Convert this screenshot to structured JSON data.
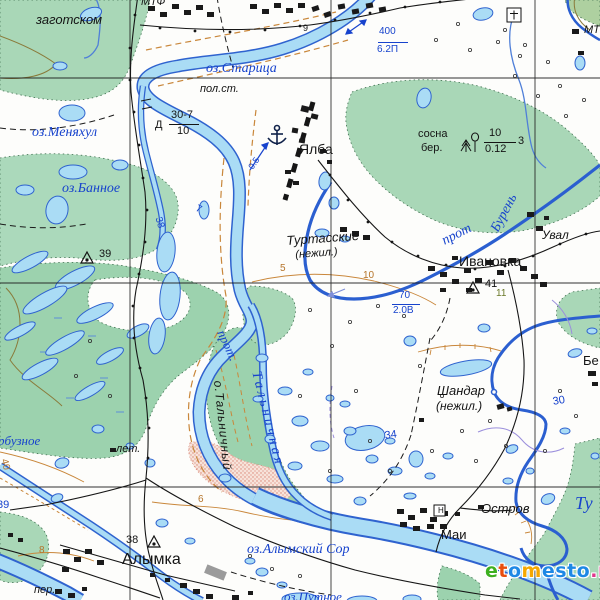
{
  "watermark": {
    "text": "etomesto.ru",
    "letters": [
      {
        "ch": "e",
        "color": "#3db020"
      },
      {
        "ch": "t",
        "color": "#e84e0f"
      },
      {
        "ch": "o",
        "color": "#1e88e5"
      },
      {
        "ch": "m",
        "color": "#f5a800"
      },
      {
        "ch": "e",
        "color": "#1e88e5"
      },
      {
        "ch": "s",
        "color": "#1e88e5"
      },
      {
        "ch": "t",
        "color": "#1e88e5"
      },
      {
        "ch": "o",
        "color": "#1e88e5"
      },
      {
        "ch": ".",
        "color": "#e0368c"
      },
      {
        "ch": "r",
        "color": "#e0368c"
      },
      {
        "ch": "u",
        "color": "#e0368c"
      }
    ]
  },
  "map": {
    "colors": {
      "water_fill": "#aadcf5",
      "water_line": "#2f63cf",
      "forest": "#a9d7b7",
      "marsh_forest": "#9cd2ae",
      "contour": "#c9873b",
      "sand": "#f7e3da",
      "building": "#1a1a1a",
      "grid": "#1b1b1b",
      "label_water": "#1743cd",
      "label_black": "#141414"
    },
    "labels": [
      {
        "id": "oz-staritsa",
        "text": "оз.Старица",
        "cls": "water",
        "x": 206,
        "y": 62,
        "size": 14
      },
      {
        "id": "oz-menyakhul",
        "text": "оз.Меняхул",
        "cls": "water",
        "x": 32,
        "y": 126,
        "size": 14
      },
      {
        "id": "oz-bannoe",
        "text": "оз.Банное",
        "cls": "water",
        "x": 62,
        "y": 182,
        "size": 14
      },
      {
        "id": "prot-buren-1",
        "text": "прот",
        "cls": "water",
        "x": 440,
        "y": 236,
        "size": 14,
        "rot": -27
      },
      {
        "id": "prot-buren-2",
        "text": "Бурень",
        "cls": "water",
        "x": 489,
        "y": 228,
        "size": 14,
        "rot": -62
      },
      {
        "id": "prot-talnichnaya-1",
        "text": "прот.",
        "cls": "water",
        "x": 227,
        "y": 328,
        "size": 13,
        "rot": 65
      },
      {
        "id": "prot-talnichnaya-2",
        "text": "Тальничная",
        "cls": "water",
        "x": 262,
        "y": 370,
        "size": 14,
        "rot": 76,
        "ls": 3
      },
      {
        "id": "o-talnichny",
        "text": "о.Тальничный",
        "cls": "blki",
        "x": 224,
        "y": 380,
        "size": 12,
        "rot": 84,
        "ls": 1
      },
      {
        "id": "oz-alymsky-sor",
        "text": "оз.Алымский Сор",
        "cls": "water",
        "x": 247,
        "y": 543,
        "size": 14
      },
      {
        "id": "oz-putnoe",
        "text": "оз.Путное",
        "cls": "water",
        "x": 284,
        "y": 590,
        "size": 13
      },
      {
        "id": "river-tu",
        "text": "Ту",
        "cls": "water",
        "x": 575,
        "y": 494,
        "size": 18
      },
      {
        "id": "oz-arbuznoe",
        "text": "рбузное",
        "cls": "water",
        "x": -2,
        "y": 434,
        "size": 13
      },
      {
        "id": "w-400",
        "text": "400",
        "cls": "blue-num",
        "x": 379,
        "y": 27,
        "size": 10
      },
      {
        "id": "w-62p",
        "text": "6.2П",
        "cls": "blue-num",
        "x": 377,
        "y": 45,
        "size": 10
      },
      {
        "id": "w-70",
        "text": "70",
        "cls": "blue-num",
        "x": 399,
        "y": 291,
        "size": 10
      },
      {
        "id": "w-20v",
        "text": "2.0В",
        "cls": "blue-num",
        "x": 393,
        "y": 306,
        "size": 10
      },
      {
        "id": "flow-05",
        "text": "0.5",
        "cls": "blue-num",
        "x": 247,
        "y": 166,
        "size": 9,
        "rot": -55
      },
      {
        "id": "num-38-blue",
        "text": "38",
        "cls": "blue-num",
        "x": 162,
        "y": 216,
        "size": 10,
        "rot": 72
      },
      {
        "id": "num-7-blue",
        "text": "7",
        "cls": "blue-num",
        "x": 198,
        "y": 204,
        "size": 10,
        "rot": 25
      },
      {
        "id": "num-34",
        "text": "34",
        "cls": "blue-num",
        "x": 384,
        "y": 431,
        "size": 11,
        "rot": -8
      },
      {
        "id": "num-30",
        "text": "30",
        "cls": "blue-num",
        "x": 552,
        "y": 397,
        "size": 11,
        "rot": -10
      },
      {
        "id": "num-39-blue",
        "text": "39",
        "cls": "blue-num",
        "x": -3,
        "y": 500,
        "size": 11
      },
      {
        "id": "yalba",
        "text": "Ялба",
        "cls": "blk",
        "x": 299,
        "y": 142,
        "size": 14
      },
      {
        "id": "ivanovka",
        "text": "Ивановка",
        "cls": "blk",
        "x": 459,
        "y": 254,
        "size": 14
      },
      {
        "id": "alymka",
        "text": "Алымка",
        "cls": "blk",
        "x": 122,
        "y": 552,
        "size": 16
      },
      {
        "id": "mai",
        "text": "Маи",
        "cls": "blk",
        "x": 441,
        "y": 528,
        "size": 13
      },
      {
        "id": "zagotskom",
        "text": "заготском",
        "cls": "blki",
        "x": 36,
        "y": 13,
        "size": 13
      },
      {
        "id": "mtf",
        "text": "МТФ",
        "cls": "blki",
        "x": 141,
        "y": -3,
        "size": 11
      },
      {
        "id": "mtf-right",
        "text": "МТФ",
        "cls": "blki",
        "x": 584,
        "y": 25,
        "size": 11
      },
      {
        "id": "pol-st",
        "text": "пол.ст.",
        "cls": "blki",
        "x": 200,
        "y": 84,
        "size": 11
      },
      {
        "id": "turtasskie",
        "text": "Туртасские",
        "cls": "blki",
        "x": 286,
        "y": 234,
        "size": 13,
        "rot": -4
      },
      {
        "id": "turtasskie-nezhil",
        "text": "(нежил.)",
        "cls": "blki",
        "x": 295,
        "y": 250,
        "size": 11,
        "rot": -4
      },
      {
        "id": "shandar",
        "text": "Шандар",
        "cls": "blki",
        "x": 437,
        "y": 384,
        "size": 13
      },
      {
        "id": "shandar-nezhil",
        "text": "(нежил.)",
        "cls": "blki",
        "x": 436,
        "y": 400,
        "size": 12
      },
      {
        "id": "uval",
        "text": "Увал",
        "cls": "blki",
        "x": 542,
        "y": 229,
        "size": 12
      },
      {
        "id": "ostrov",
        "text": "Остров",
        "cls": "blki",
        "x": 481,
        "y": 502,
        "size": 13
      },
      {
        "id": "be-partial",
        "text": "Бе",
        "cls": "blk",
        "x": 583,
        "y": 354,
        "size": 13
      },
      {
        "id": "let",
        "text": "лет.",
        "cls": "blki",
        "x": 116,
        "y": 444,
        "size": 11
      },
      {
        "id": "per",
        "text": "пер.",
        "cls": "blki",
        "x": 34,
        "y": 585,
        "size": 11
      },
      {
        "id": "forest-sosna",
        "text": "сосна",
        "cls": "blk",
        "x": 418,
        "y": 129,
        "size": 11
      },
      {
        "id": "forest-ber",
        "text": "бер.",
        "cls": "blk",
        "x": 421,
        "y": 143,
        "size": 11
      },
      {
        "id": "forest-10",
        "text": "10",
        "cls": "blk",
        "x": 489,
        "y": 128,
        "size": 11
      },
      {
        "id": "forest-012",
        "text": "0.12",
        "cls": "blk",
        "x": 485,
        "y": 144,
        "size": 11
      },
      {
        "id": "forest-3",
        "text": "3",
        "cls": "blk",
        "x": 518,
        "y": 136,
        "size": 11
      },
      {
        "id": "bridge-d",
        "text": "Д",
        "cls": "blk",
        "x": 155,
        "y": 120,
        "size": 11
      },
      {
        "id": "bridge-307",
        "text": "30-7",
        "cls": "blk",
        "x": 171,
        "y": 110,
        "size": 11
      },
      {
        "id": "bridge-10",
        "text": "10",
        "cls": "blk",
        "x": 177,
        "y": 126,
        "size": 11
      },
      {
        "id": "elev-39",
        "text": "39",
        "cls": "blk",
        "x": 99,
        "y": 249,
        "size": 11
      },
      {
        "id": "elev-41",
        "text": "41",
        "cls": "blk",
        "x": 485,
        "y": 279,
        "size": 11
      },
      {
        "id": "elev-38",
        "text": "38",
        "cls": "blk",
        "x": 126,
        "y": 535,
        "size": 11
      },
      {
        "id": "num-9",
        "text": "9",
        "cls": "blk",
        "x": 303,
        "y": 24,
        "size": 9
      },
      {
        "id": "num-11",
        "text": "11",
        "cls": "olive",
        "x": 496,
        "y": 289,
        "size": 10
      },
      {
        "id": "contour-5",
        "text": "5",
        "cls": "brown",
        "x": 280,
        "y": 264,
        "size": 10
      },
      {
        "id": "contour-10",
        "text": "10",
        "cls": "brown",
        "x": 363,
        "y": 271,
        "size": 10
      },
      {
        "id": "contour-6",
        "text": "6",
        "cls": "brown",
        "x": 198,
        "y": 495,
        "size": 10
      },
      {
        "id": "contour-8",
        "text": "8",
        "cls": "brown",
        "x": 39,
        "y": 546,
        "size": 10
      },
      {
        "id": "contour-40",
        "text": "40",
        "cls": "brown",
        "x": 8,
        "y": 458,
        "size": 10,
        "rot": 75
      },
      {
        "id": "sym-h",
        "text": "Н",
        "cls": "blk",
        "x": 438,
        "y": 507,
        "size": 8
      }
    ],
    "rules": [
      {
        "id": "frac-400",
        "x": 378,
        "y": 42,
        "w": 30,
        "c": "#1743cd"
      },
      {
        "id": "frac-70",
        "x": 392,
        "y": 304,
        "w": 28,
        "c": "#1743cd"
      },
      {
        "id": "frac-bridge",
        "x": 169,
        "y": 124,
        "w": 30,
        "c": "#141414"
      },
      {
        "id": "frac-forest",
        "x": 484,
        "y": 142,
        "w": 32,
        "c": "#141414"
      }
    ]
  }
}
